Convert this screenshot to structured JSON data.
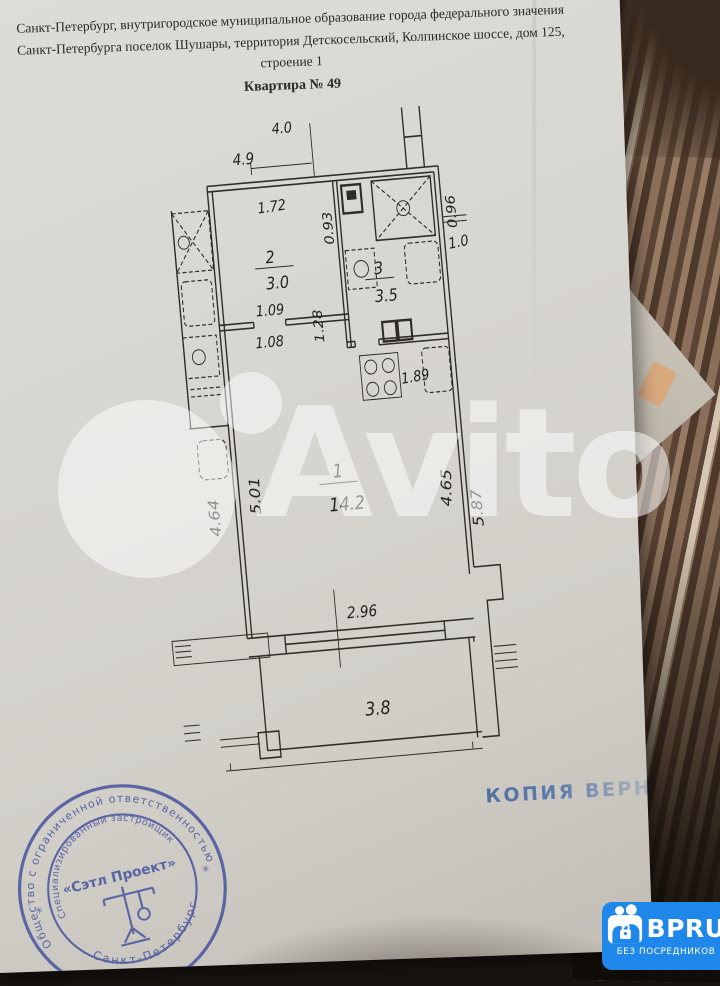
{
  "header": {
    "line1": "Санкт-Петербург, внутригородское муниципальное образование города федерального значения",
    "line2": "Санкт-Петербурга поселок Шушары, территория Детскосельский, Колпинское шоссе, дом 125,",
    "line3": "строение 1",
    "line4": "Квартира № 49"
  },
  "plan": {
    "rooms": {
      "room1": {
        "number": "1",
        "area": "14.2"
      },
      "room2": {
        "number": "2",
        "area": "3.0"
      },
      "room3": {
        "number": "3",
        "area": "3.5"
      },
      "balcony": {
        "area": "3.8"
      }
    },
    "dims": {
      "top_a": "4.0",
      "top_b": "4.9",
      "hall_w": "1.72",
      "hall_d": "0.93",
      "hall_h": "1.28",
      "pass_a": "1.09",
      "pass_b": "1.08",
      "kitchen": "1.89",
      "right_a": "0.96",
      "right_b": "1.0",
      "left_out": "4.64",
      "left_in": "5.01",
      "right_in": "4.65",
      "right_out": "5.87",
      "balcony_w": "2.96"
    }
  },
  "watermark": {
    "text": "Avito"
  },
  "copy_stamp": {
    "text": "КОПИЯ ВЕРНА"
  },
  "round_stamp": {
    "outer_top": "Общество с ограниченной ответственностью",
    "inner_top": "Специализированный застройщик",
    "center": "«Сэтл Проект»",
    "outer_bottom": "Санкт-Петербург",
    "star": "✳"
  },
  "badge": {
    "brand": "BPRU",
    "tagline": "БЕЗ ПОСРЕДНИКОВ"
  },
  "colors": {
    "stamp_blue": "#47549f",
    "badge_blue": "#1e87e9",
    "paper": "#d8d6d1"
  }
}
